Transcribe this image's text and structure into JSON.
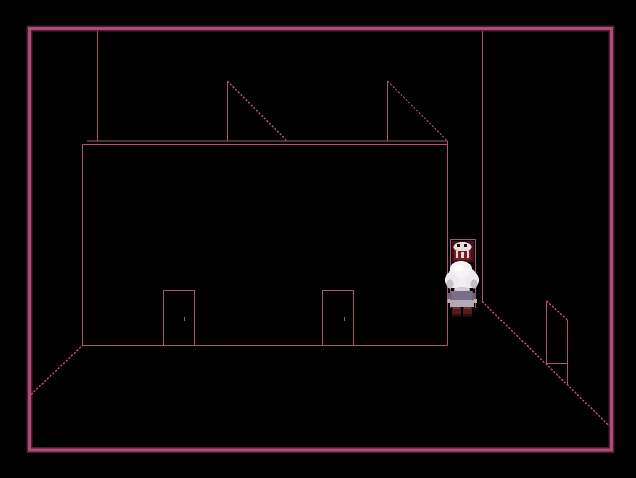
{
  "screen": {
    "width": 636,
    "height": 478
  },
  "palette": {
    "background": "#000000",
    "border": "#ae4c76",
    "border_shadow": "#4b1c33",
    "wire": "#b0517d"
  },
  "scene": {
    "border": {
      "x": 29.5,
      "y": 28.5,
      "w": 582,
      "h": 421.5
    },
    "wireframe": [
      {
        "name": "ceiling-edge-left",
        "x1": 97.5,
        "y1": 31,
        "x2": 97.5,
        "y2": 141,
        "dashed": false
      },
      {
        "name": "ceiling-edge-right",
        "x1": 482.5,
        "y1": 31,
        "x2": 482.5,
        "y2": 301.5,
        "dashed": false
      },
      {
        "name": "wall-top-outer",
        "x1": 87,
        "y1": 141,
        "x2": 447.5,
        "y2": 141,
        "dashed": false
      },
      {
        "name": "wall-top-inner",
        "x1": 82.5,
        "y1": 144.5,
        "x2": 447.5,
        "y2": 144.5,
        "dashed": false
      },
      {
        "name": "wall-edge-left",
        "x1": 82.5,
        "y1": 144.5,
        "x2": 82.5,
        "y2": 345.5,
        "dashed": false
      },
      {
        "name": "wall-edge-right",
        "x1": 447.5,
        "y1": 141,
        "x2": 447.5,
        "y2": 345.5,
        "dashed": false
      },
      {
        "name": "wall-base-floor-line",
        "x1": 82,
        "y1": 345.5,
        "x2": 447.5,
        "y2": 345.5,
        "dashed": false
      },
      {
        "name": "floor-corner-diagonal-left",
        "x1": 31,
        "y1": 394.5,
        "x2": 82.5,
        "y2": 345.5,
        "dashed": true
      },
      {
        "name": "roof-hatch-left-post",
        "x1": 227.5,
        "y1": 81,
        "x2": 227.5,
        "y2": 141,
        "dashed": false
      },
      {
        "name": "roof-hatch-left-diagonal",
        "x1": 227.5,
        "y1": 81,
        "x2": 286.5,
        "y2": 140.5,
        "dashed": true
      },
      {
        "name": "roof-hatch-right-post",
        "x1": 387.5,
        "y1": 81,
        "x2": 387.5,
        "y2": 141,
        "dashed": false
      },
      {
        "name": "roof-hatch-right-diagonal",
        "x1": 387.5,
        "y1": 81,
        "x2": 447,
        "y2": 140.5,
        "dashed": true
      },
      {
        "name": "left-door-left-edge",
        "x1": 163.5,
        "y1": 290,
        "x2": 163.5,
        "y2": 345,
        "dashed": false
      },
      {
        "name": "left-door-right-edge",
        "x1": 194.5,
        "y1": 290,
        "x2": 194.5,
        "y2": 345,
        "dashed": false
      },
      {
        "name": "left-door-top-edge",
        "x1": 163.5,
        "y1": 290.5,
        "x2": 194.5,
        "y2": 290.5,
        "dashed": false
      },
      {
        "name": "left-door-knob",
        "x1": 184.5,
        "y1": 317,
        "x2": 184.5,
        "y2": 321,
        "dashed": false
      },
      {
        "name": "right-door-left-edge",
        "x1": 322.5,
        "y1": 290,
        "x2": 322.5,
        "y2": 345,
        "dashed": false
      },
      {
        "name": "right-door-right-edge",
        "x1": 353.5,
        "y1": 290,
        "x2": 353.5,
        "y2": 345,
        "dashed": false
      },
      {
        "name": "right-door-top-edge",
        "x1": 322.5,
        "y1": 290.5,
        "x2": 353.5,
        "y2": 290.5,
        "dashed": false
      },
      {
        "name": "right-door-knob",
        "x1": 344.5,
        "y1": 317,
        "x2": 344.5,
        "y2": 321,
        "dashed": false
      },
      {
        "name": "right-wall-base-diagonal",
        "x1": 482,
        "y1": 301.5,
        "x2": 609.5,
        "y2": 426,
        "dashed": true
      },
      {
        "name": "side-door-left-edge",
        "x1": 546.5,
        "y1": 301,
        "x2": 546.5,
        "y2": 363.5,
        "dashed": false
      },
      {
        "name": "side-door-right-edge",
        "x1": 567.5,
        "y1": 320,
        "x2": 567.5,
        "y2": 385,
        "dashed": false
      },
      {
        "name": "side-door-top-diagonal",
        "x1": 546.5,
        "y1": 301,
        "x2": 567.5,
        "y2": 320,
        "dashed": true
      },
      {
        "name": "side-door-bottom-edge",
        "x1": 546.5,
        "y1": 363.5,
        "x2": 567.5,
        "y2": 363.5,
        "dashed": false
      },
      {
        "name": "back-doorway-left-edge",
        "x1": 450.5,
        "y1": 239,
        "x2": 450.5,
        "y2": 308,
        "dashed": false
      },
      {
        "name": "back-doorway-right-edge",
        "x1": 475.5,
        "y1": 239,
        "x2": 475.5,
        "y2": 308,
        "dashed": false
      },
      {
        "name": "back-doorway-top-edge",
        "x1": 450,
        "y1": 239.5,
        "x2": 476,
        "y2": 239.5,
        "dashed": false
      }
    ],
    "doorway_art": [
      {
        "name": "doorway-interior",
        "type": "rect",
        "x": 452,
        "y": 241,
        "w": 22,
        "h": 21,
        "fill": "#450f17"
      },
      {
        "name": "doorway-figure-hair",
        "type": "ellipse",
        "cx": 462.5,
        "cy": 247,
        "rx": 9,
        "ry": 5,
        "fill": "#e7dddd"
      },
      {
        "name": "doorway-figure-eye-left",
        "type": "rect",
        "x": 457,
        "y": 244,
        "w": 3,
        "h": 3,
        "fill": "#2e070d"
      },
      {
        "name": "doorway-figure-eye-right",
        "type": "rect",
        "x": 464,
        "y": 244,
        "w": 3,
        "h": 3,
        "fill": "#2e070d"
      },
      {
        "name": "doorway-figure-body",
        "type": "rect",
        "x": 454,
        "y": 251,
        "w": 17,
        "h": 9,
        "fill": "#751d26"
      },
      {
        "name": "doorway-drip-1",
        "type": "rect",
        "x": 456,
        "y": 251,
        "w": 2,
        "h": 7,
        "fill": "#e2d8d8"
      },
      {
        "name": "doorway-drip-2",
        "type": "rect",
        "x": 461,
        "y": 252,
        "w": 3,
        "h": 6,
        "fill": "#e2d8d8"
      },
      {
        "name": "doorway-drip-3",
        "type": "rect",
        "x": 467,
        "y": 251,
        "w": 2,
        "h": 7,
        "fill": "#e2d8d8"
      }
    ],
    "player_sprite": [
      {
        "name": "player-hair-main",
        "type": "ellipse",
        "cx": 462,
        "cy": 278,
        "rx": 15,
        "ry": 12,
        "fill": "#f0eef0"
      },
      {
        "name": "player-hair-puff-left",
        "type": "ellipse",
        "cx": 452,
        "cy": 280,
        "rx": 7,
        "ry": 8,
        "fill": "#eceaec"
      },
      {
        "name": "player-hair-puff-right",
        "type": "ellipse",
        "cx": 472,
        "cy": 280,
        "rx": 7,
        "ry": 8,
        "fill": "#eceaec"
      },
      {
        "name": "player-hair-puff-top",
        "type": "ellipse",
        "cx": 461,
        "cy": 269,
        "rx": 11,
        "ry": 8,
        "fill": "#f5f3f5"
      },
      {
        "name": "player-hair-shade-left",
        "type": "ellipse",
        "cx": 450,
        "cy": 284,
        "rx": 3.5,
        "ry": 4.5,
        "fill": "#c6c0c6"
      },
      {
        "name": "player-hair-shade-right",
        "type": "ellipse",
        "cx": 474,
        "cy": 284,
        "rx": 3.5,
        "ry": 4.5,
        "fill": "#c6c0c6"
      },
      {
        "name": "player-hair-shade-bottom",
        "type": "ellipse",
        "cx": 462,
        "cy": 290,
        "rx": 8,
        "ry": 3,
        "fill": "#d4ced4"
      },
      {
        "name": "player-hair-highlight",
        "type": "ellipse",
        "cx": 459,
        "cy": 268,
        "rx": 5.5,
        "ry": 3.5,
        "fill": "#fdfcfd"
      },
      {
        "name": "player-torso",
        "type": "rect",
        "x": 451,
        "y": 291,
        "w": 22,
        "h": 10,
        "fill": "#7a7084"
      },
      {
        "name": "player-arm-left",
        "type": "rect",
        "x": 448,
        "y": 293,
        "w": 4,
        "h": 9,
        "fill": "#6e6478"
      },
      {
        "name": "player-arm-right",
        "type": "rect",
        "x": 472,
        "y": 293,
        "w": 4,
        "h": 9,
        "fill": "#6e6478"
      },
      {
        "name": "player-hand-left",
        "type": "rect",
        "x": 447.5,
        "y": 299,
        "w": 3,
        "h": 4,
        "fill": "#c9aba3"
      },
      {
        "name": "player-hand-right",
        "type": "rect",
        "x": 474,
        "y": 299,
        "w": 3,
        "h": 4,
        "fill": "#c9aba3"
      },
      {
        "name": "player-skirt",
        "type": "rect",
        "x": 450,
        "y": 300,
        "w": 24,
        "h": 7,
        "fill": "#b3a9bb"
      },
      {
        "name": "player-shoe-left",
        "type": "rect",
        "x": 452,
        "y": 307,
        "w": 9,
        "h": 9,
        "fill": "#521d1d"
      },
      {
        "name": "player-shoe-right",
        "type": "rect",
        "x": 463,
        "y": 307,
        "w": 9,
        "h": 9,
        "fill": "#521d1d"
      },
      {
        "name": "player-shoe-highlight-left",
        "type": "rect",
        "x": 453,
        "y": 307,
        "w": 7,
        "h": 2,
        "fill": "#763030"
      },
      {
        "name": "player-shoe-highlight-right",
        "type": "rect",
        "x": 464,
        "y": 307,
        "w": 7,
        "h": 2,
        "fill": "#763030"
      },
      {
        "name": "player-sole-left",
        "type": "rect",
        "x": 452,
        "y": 314,
        "w": 9,
        "h": 2.5,
        "fill": "#2e0e0e"
      },
      {
        "name": "player-sole-right",
        "type": "rect",
        "x": 463,
        "y": 314,
        "w": 9,
        "h": 2.5,
        "fill": "#2e0e0e"
      }
    ]
  }
}
